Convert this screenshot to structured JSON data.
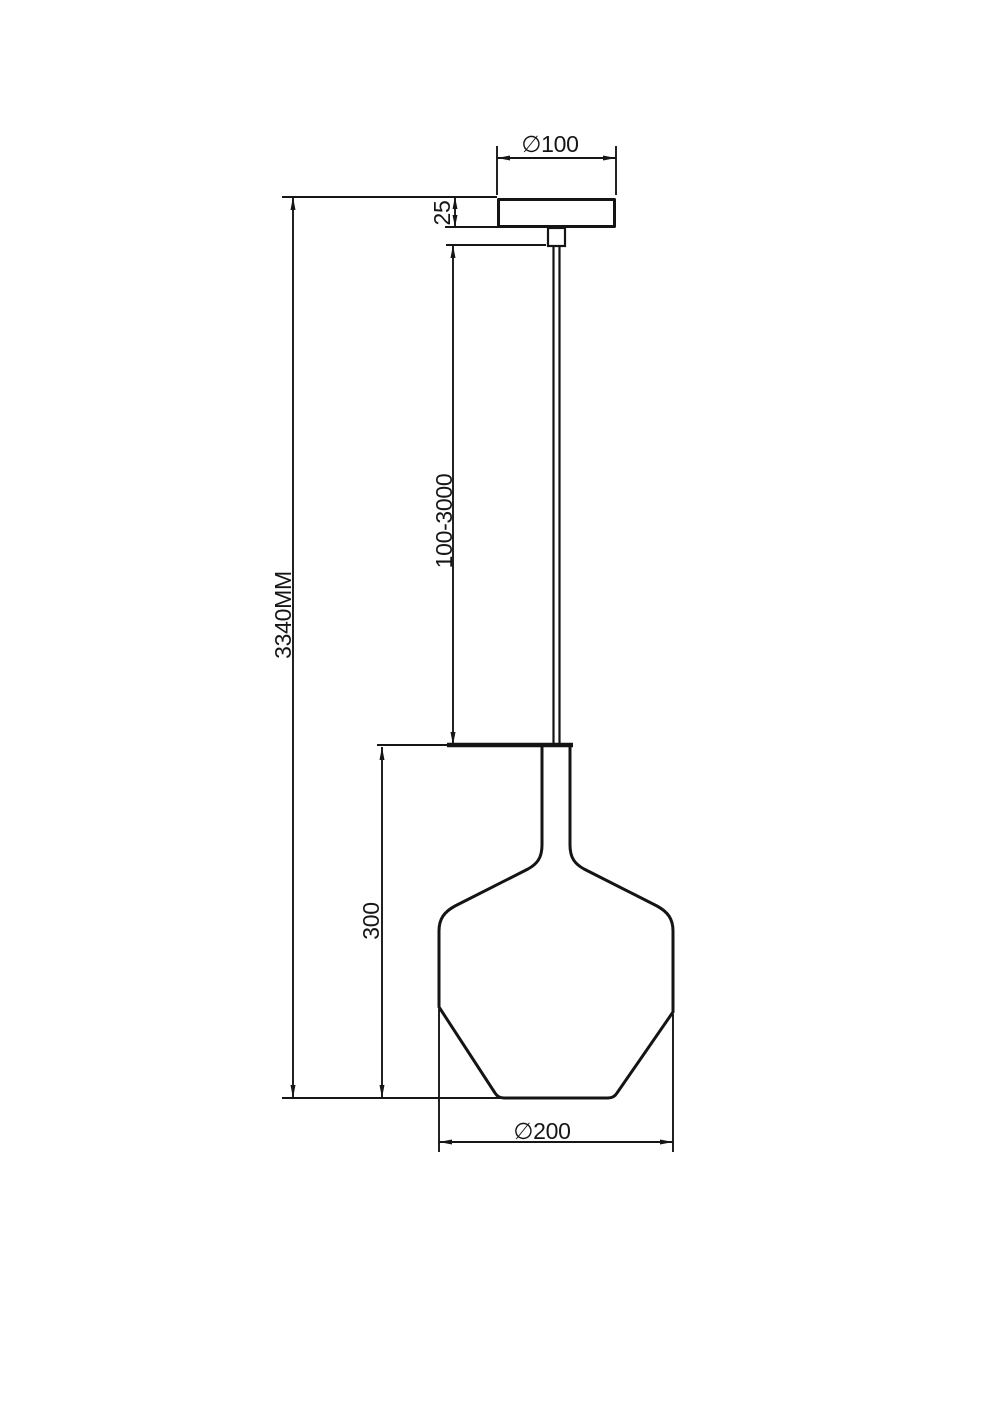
{
  "page": {
    "background": "#ffffff",
    "line_color": "#141414"
  },
  "drawing": {
    "type": "technical-dimension-drawing",
    "subject": "pendant lamp front elevation",
    "unit": "MM",
    "labels": {
      "canopy_diameter": "∅100",
      "canopy_height": "25",
      "suspension_length_range": "100-3000",
      "overall_height": "3340MM",
      "shade_height": "300",
      "shade_diameter": "∅200"
    }
  }
}
